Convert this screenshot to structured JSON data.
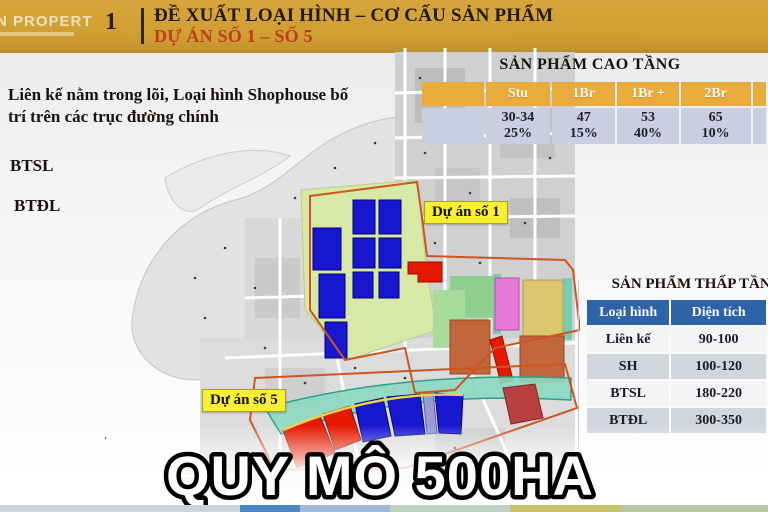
{
  "header": {
    "logo_text": "N PROPERTY",
    "section_number": "1",
    "title": "ĐỀ XUẤT LOẠI HÌNH – CƠ CẤU SẢN PHẨM",
    "subtitle": "DỰ ÁN SỐ 1 – SỐ 5"
  },
  "notes": {
    "main": "Liên kế nằm trong lõi, Loại hình Shophouse bố trí trên các trục đường chính",
    "item1": "BTSL",
    "item2": "BTĐL"
  },
  "map": {
    "label_project1": "Dự án số 1",
    "label_project5": "Dự án số 5",
    "caption": "QUY MÔ 500HA"
  },
  "high_rise_table": {
    "title": "SẢN PHẨM CAO TẦNG",
    "columns": [
      "Stu",
      "1Br",
      "1Br +",
      "2Br"
    ],
    "rows": [
      {
        "area": "30-34",
        "ratio": "25%"
      },
      {
        "area": "47",
        "ratio": "15%"
      },
      {
        "area": "53",
        "ratio": "40%"
      },
      {
        "area": "65",
        "ratio": "10%"
      }
    ]
  },
  "low_rise_table": {
    "title": "SẢN PHẨM THẤP TẦNG",
    "columns": [
      "Loại hình",
      "Diện tích"
    ],
    "rows": [
      {
        "type": "Liên kế",
        "area": "90-100"
      },
      {
        "type": "SH",
        "area": "100-120"
      },
      {
        "type": "BTSL",
        "area": "180-220"
      },
      {
        "type": "BTĐL",
        "area": "300-350"
      }
    ]
  },
  "colors": {
    "header_gold": "#D0A033",
    "subtitle_red": "#C03A1B",
    "table_header_gold": "#E9AC3C",
    "table_row_blue_gray": "#C9CFE0",
    "low_rise_header_blue": "#2E63A8",
    "project_label_yellow": "#F8EF33",
    "parcel_blue": "#1717D0",
    "parcel_red": "#E51800",
    "boundary_orange": "#CC5522"
  }
}
